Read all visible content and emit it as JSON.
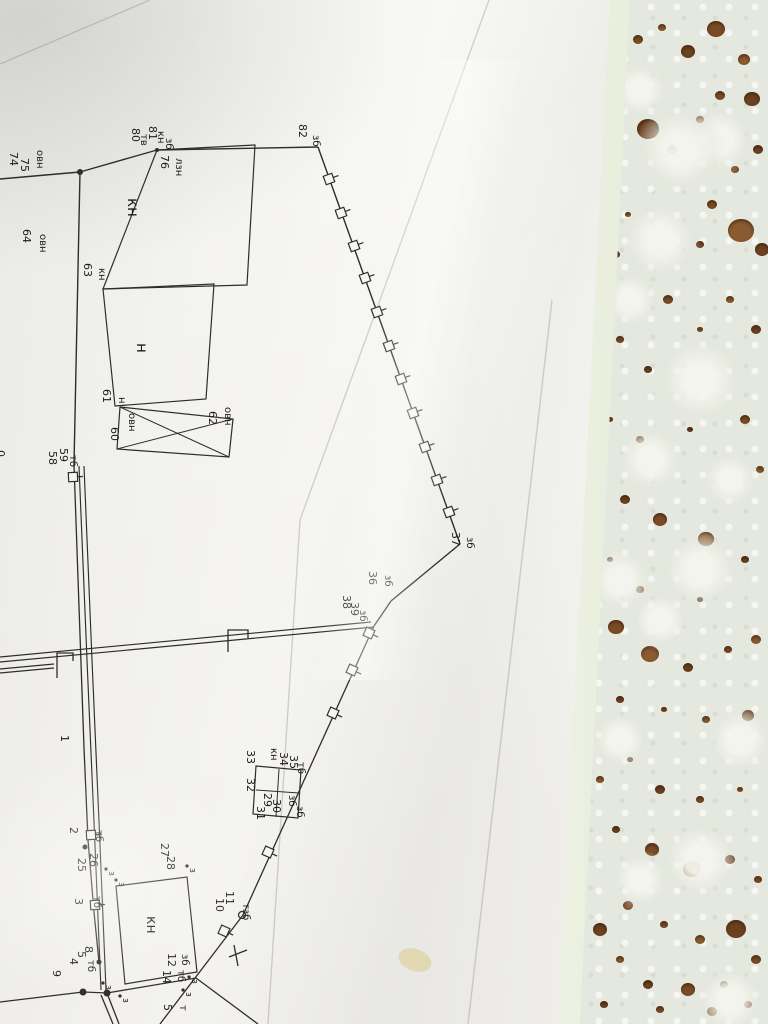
{
  "scene": {
    "description_colors": {
      "paper": "#f5f5f2",
      "ink": "#2e2d2b",
      "lace_base": "#e5e8de",
      "wood_through_holes": "#7a4c26",
      "plastic_edge": "#fbfdf6",
      "stain": "#d8c272"
    }
  },
  "drawing": {
    "labels": [
      {
        "t": "74",
        "x": 10,
        "y": 152
      },
      {
        "t": "75",
        "x": 21,
        "y": 158
      },
      {
        "t": "овн",
        "x": 37,
        "y": 150,
        "s": 10
      },
      {
        "t": "80",
        "x": 132,
        "y": 128
      },
      {
        "t": "тв",
        "x": 141,
        "y": 134,
        "s": 10
      },
      {
        "t": "81",
        "x": 149,
        "y": 126
      },
      {
        "t": "кн",
        "x": 158,
        "y": 131,
        "s": 10
      },
      {
        "t": "зб",
        "x": 166,
        "y": 138,
        "s": 10
      },
      {
        "t": "76",
        "x": 161,
        "y": 155
      },
      {
        "t": "лзн",
        "x": 176,
        "y": 158,
        "s": 10
      },
      {
        "t": "82",
        "x": 299,
        "y": 124
      },
      {
        "t": "зб",
        "x": 313,
        "y": 135,
        "s": 10
      },
      {
        "t": "64",
        "x": 23,
        "y": 229
      },
      {
        "t": "овн",
        "x": 40,
        "y": 234,
        "s": 10
      },
      {
        "t": "кн",
        "x": 128,
        "y": 198,
        "s": 15
      },
      {
        "t": "63",
        "x": 84,
        "y": 263
      },
      {
        "t": "кн",
        "x": 99,
        "y": 268,
        "s": 10
      },
      {
        "t": "н",
        "x": 137,
        "y": 343,
        "s": 15
      },
      {
        "t": "61",
        "x": 103,
        "y": 389
      },
      {
        "t": "н",
        "x": 119,
        "y": 397,
        "s": 10
      },
      {
        "t": "60",
        "x": 111,
        "y": 427
      },
      {
        "t": "овн",
        "x": 129,
        "y": 413,
        "s": 10
      },
      {
        "t": "62",
        "x": 209,
        "y": 411
      },
      {
        "t": "овн",
        "x": 225,
        "y": 407,
        "s": 10
      },
      {
        "t": "58",
        "x": 49,
        "y": 451
      },
      {
        "t": "59",
        "x": 60,
        "y": 448
      },
      {
        "t": "тб",
        "x": 70,
        "y": 455,
        "s": 10
      },
      {
        "t": "0",
        "x": -3,
        "y": 450
      },
      {
        "t": "37",
        "x": 452,
        "y": 532
      },
      {
        "t": "зб",
        "x": 467,
        "y": 537,
        "s": 10
      },
      {
        "t": "36",
        "x": 369,
        "y": 571
      },
      {
        "t": "зб",
        "x": 385,
        "y": 575,
        "s": 10
      },
      {
        "t": "38",
        "x": 343,
        "y": 595
      },
      {
        "t": "39",
        "x": 351,
        "y": 602
      },
      {
        "t": "зб",
        "x": 360,
        "y": 610,
        "s": 10
      },
      {
        "t": "1",
        "x": 61,
        "y": 735
      },
      {
        "t": "2",
        "x": 70,
        "y": 827
      },
      {
        "t": "тб",
        "x": 96,
        "y": 830,
        "s": 10
      },
      {
        "t": "25",
        "x": 78,
        "y": 858
      },
      {
        "t": "26",
        "x": 90,
        "y": 853
      },
      {
        "t": "3",
        "x": 75,
        "y": 898
      },
      {
        "t": "тб",
        "x": 94,
        "y": 896,
        "s": 10
      },
      {
        "t": "27",
        "x": 161,
        "y": 843
      },
      {
        "t": "28",
        "x": 167,
        "y": 856
      },
      {
        "t": "32",
        "x": 247,
        "y": 778
      },
      {
        "t": "33",
        "x": 247,
        "y": 750
      },
      {
        "t": "кн",
        "x": 271,
        "y": 748,
        "s": 10
      },
      {
        "t": "34",
        "x": 280,
        "y": 752
      },
      {
        "t": "35",
        "x": 290,
        "y": 755
      },
      {
        "t": "тб",
        "x": 298,
        "y": 762,
        "s": 10
      },
      {
        "t": "29",
        "x": 264,
        "y": 793
      },
      {
        "t": "30",
        "x": 273,
        "y": 799
      },
      {
        "t": "31",
        "x": 257,
        "y": 806
      },
      {
        "t": "зб",
        "x": 289,
        "y": 795,
        "s": 10
      },
      {
        "t": "зб",
        "x": 297,
        "y": 806,
        "s": 10
      },
      {
        "t": "10",
        "x": 216,
        "y": 898
      },
      {
        "t": "11",
        "x": 226,
        "y": 891
      },
      {
        "t": "тзб",
        "x": 243,
        "y": 903,
        "s": 10
      },
      {
        "t": "9",
        "x": 53,
        "y": 970
      },
      {
        "t": "4",
        "x": 70,
        "y": 958
      },
      {
        "t": "5",
        "x": 78,
        "y": 951
      },
      {
        "t": "8",
        "x": 85,
        "y": 946
      },
      {
        "t": "тб",
        "x": 88,
        "y": 960,
        "s": 10
      },
      {
        "t": "12",
        "x": 168,
        "y": 953
      },
      {
        "t": "зб",
        "x": 182,
        "y": 954,
        "s": 10
      },
      {
        "t": "14",
        "x": 163,
        "y": 970
      },
      {
        "t": "тб",
        "x": 178,
        "y": 970,
        "s": 10
      },
      {
        "t": "кн",
        "x": 147,
        "y": 916,
        "s": 14
      },
      {
        "t": "5",
        "x": 164,
        "y": 1004
      },
      {
        "t": "т",
        "x": 180,
        "y": 1005,
        "s": 10
      }
    ],
    "single_lines": [
      [
        0,
        179,
        80,
        172
      ],
      [
        80,
        172,
        157,
        150
      ],
      [
        157,
        150,
        318,
        147
      ],
      [
        318,
        147,
        460,
        544
      ],
      [
        460,
        544,
        391,
        601
      ],
      [
        391,
        601,
        374,
        626
      ],
      [
        80,
        172,
        74,
        465
      ]
    ],
    "polylines": [
      [
        [
          74,
          465
        ],
        [
          84,
          748
        ],
        [
          88,
          840
        ],
        [
          94,
          912
        ],
        [
          99,
          962
        ]
      ],
      [
        [
          374,
          626
        ],
        [
          243,
          915
        ],
        [
          160,
          1024
        ]
      ],
      [
        [
          0,
          1002
        ],
        [
          83,
          992
        ],
        [
          107,
          993
        ]
      ],
      [
        [
          107,
          993
        ],
        [
          196,
          978
        ],
        [
          258,
          1024
        ]
      ],
      [
        [
          101,
          995
        ],
        [
          113,
          1024
        ]
      ],
      [
        [
          107,
          993
        ],
        [
          119,
          1024
        ]
      ],
      [
        [
          57,
          678
        ],
        [
          57,
          653
        ],
        [
          73,
          653
        ],
        [
          73,
          661
        ]
      ],
      [
        [
          228,
          652
        ],
        [
          228,
          630
        ],
        [
          248,
          630
        ],
        [
          248,
          638
        ]
      ],
      [
        [
          229,
          957
        ],
        [
          247,
          950
        ]
      ],
      [
        [
          234,
          945
        ],
        [
          238,
          966
        ]
      ]
    ],
    "double_lines": [
      [
        [
          0,
          662
        ],
        [
          374,
          627
        ]
      ],
      [
        [
          0,
          657
        ],
        [
          371,
          622
        ]
      ],
      [
        [
          79,
          466
        ],
        [
          87,
          660
        ],
        [
          95,
          845
        ],
        [
          101,
          990
        ]
      ],
      [
        [
          84,
          466
        ],
        [
          92,
          660
        ],
        [
          100,
          845
        ],
        [
          106,
          990
        ]
      ],
      [
        [
          0,
          669
        ],
        [
          54,
          664
        ]
      ],
      [
        [
          0,
          673
        ],
        [
          54,
          668
        ]
      ]
    ],
    "buildings": [
      {
        "pts": [
          [
            157,
            150
          ],
          [
            255,
            145
          ],
          [
            247,
            285
          ],
          [
            103,
            289
          ]
        ],
        "cross": false
      },
      {
        "pts": [
          [
            103,
            289
          ],
          [
            214,
            284
          ],
          [
            206,
            399
          ],
          [
            115,
            406
          ]
        ],
        "cross": false
      },
      {
        "pts": [
          [
            120,
            407
          ],
          [
            233,
            419
          ],
          [
            229,
            457
          ],
          [
            117,
            449
          ]
        ],
        "cross": true
      },
      {
        "pts": [
          [
            116,
            886
          ],
          [
            187,
            877
          ],
          [
            197,
            972
          ],
          [
            125,
            984
          ]
        ],
        "cross": false
      },
      {
        "pts": [
          [
            256,
            766
          ],
          [
            301,
            770
          ],
          [
            298,
            818
          ],
          [
            253,
            814
          ]
        ],
        "cross": false
      }
    ],
    "partitions": [
      [
        [
          256,
          790
        ],
        [
          299,
          793
        ]
      ],
      [
        [
          279,
          769
        ],
        [
          276,
          817
        ]
      ]
    ],
    "posts": [
      {
        "x": 329,
        "y": 179,
        "a": 70
      },
      {
        "x": 341,
        "y": 213,
        "a": 70
      },
      {
        "x": 354,
        "y": 246,
        "a": 70
      },
      {
        "x": 365,
        "y": 278,
        "a": 70
      },
      {
        "x": 377,
        "y": 312,
        "a": 70
      },
      {
        "x": 389,
        "y": 346,
        "a": 70
      },
      {
        "x": 401,
        "y": 379,
        "a": 70
      },
      {
        "x": 413,
        "y": 413,
        "a": 70
      },
      {
        "x": 425,
        "y": 447,
        "a": 70
      },
      {
        "x": 437,
        "y": 480,
        "a": 70
      },
      {
        "x": 449,
        "y": 512,
        "a": 70
      },
      {
        "x": 369,
        "y": 633,
        "a": 114
      },
      {
        "x": 352,
        "y": 670,
        "a": 114
      },
      {
        "x": 333,
        "y": 713,
        "a": 114
      },
      {
        "x": 268,
        "y": 852,
        "a": 114
      },
      {
        "x": 224,
        "y": 931,
        "a": 114
      },
      {
        "x": 73,
        "y": 477,
        "a": 87
      },
      {
        "x": 91,
        "y": 835,
        "a": 87
      },
      {
        "x": 95,
        "y": 905,
        "a": 87
      }
    ],
    "dots": [
      {
        "x": 80,
        "y": 172,
        "r": 3
      },
      {
        "x": 157,
        "y": 150,
        "r": 2
      },
      {
        "x": 85,
        "y": 847,
        "r": 2.5
      },
      {
        "x": 99,
        "y": 962,
        "r": 2.5
      },
      {
        "x": 83,
        "y": 992,
        "r": 3.5
      },
      {
        "x": 107,
        "y": 993,
        "r": 3.5
      }
    ],
    "open_circles": [
      {
        "x": 242,
        "y": 915,
        "r": 3.5
      }
    ],
    "veg_markers": [
      {
        "x": 106,
        "y": 869
      },
      {
        "x": 116,
        "y": 880
      },
      {
        "x": 187,
        "y": 866
      },
      {
        "x": 103,
        "y": 983
      },
      {
        "x": 120,
        "y": 996
      },
      {
        "x": 189,
        "y": 977
      },
      {
        "x": 183,
        "y": 990
      }
    ],
    "stain": {
      "cx": 415,
      "cy": 960,
      "rx": 17,
      "ry": 11,
      "rot": 20
    }
  }
}
